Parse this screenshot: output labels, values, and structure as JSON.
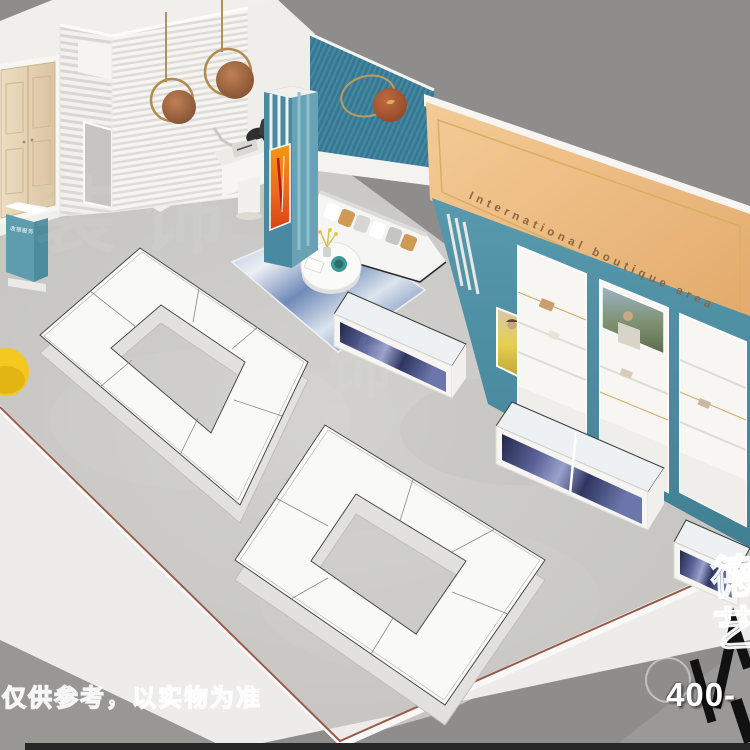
{
  "signage": {
    "boutique_area": "International boutique area"
  },
  "reception": {
    "label": "收银服务"
  },
  "watermarks": {
    "disclaimer": "仅供参考，以实物为准",
    "phone": "400-",
    "brand_char_top": "德",
    "brand_char_bottom": "艺",
    "faint": "装饰"
  },
  "palette": {
    "background_gray": "#8e8d8b",
    "floor_gray": "#c9c8c5",
    "accent_teal_wall": "#3c7f9b",
    "display_wall_teal": "#4d92a8",
    "boutique_wall_orange": "#eebd85",
    "gold_trim": "#c9a05c",
    "sofa_white": "#f5f5f3",
    "pillow_tan": "#cf9a55",
    "rug_marble_blue": "#7e93bf",
    "stool_yellow": "#f4c81e",
    "showcase_marble_navy": "#343a63",
    "door_wood": "#e6d6b8"
  }
}
